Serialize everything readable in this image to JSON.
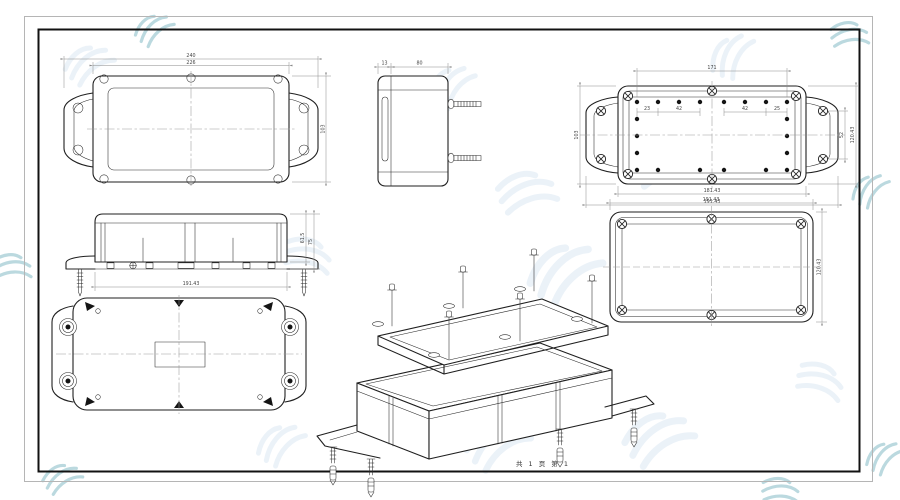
{
  "page": {
    "footer_text": "共 1 页  第 1",
    "background_color": "#ffffff",
    "frame_outer_color": "#b5b5b5",
    "frame_inner_color": "#121212",
    "line_color": "#1f1f1f",
    "dimension_color": "#8a8a8a",
    "watermark_light_color": "#dce8f4",
    "watermark_accent_color": "#79b4c0"
  },
  "views": {
    "lid_top": {
      "dims": {
        "overall_width": "240",
        "body_width": "226",
        "height": "103"
      }
    },
    "end_view": {
      "dims": {
        "lid_thickness": "13",
        "base_depth": "80"
      }
    },
    "base_inside": {
      "dims": {
        "top_hole_span": "171",
        "hole_spacing": [
          "23",
          "42",
          "42",
          "25"
        ],
        "left_height": "103",
        "right_inner_height": "52",
        "right_outer_height": "120.43",
        "bottom_inner_width": "181.43",
        "bottom_outer_width": "191.43"
      }
    },
    "lid_face": {
      "dims": {
        "width": "191.43",
        "height": "120.43"
      }
    },
    "side_elevation": {
      "dims": {
        "bottom_width": "191.43",
        "base_height": "61.5",
        "total_height": "75"
      }
    },
    "bottom_view": {
      "dims": {}
    },
    "exploded": {
      "dims": {}
    }
  }
}
